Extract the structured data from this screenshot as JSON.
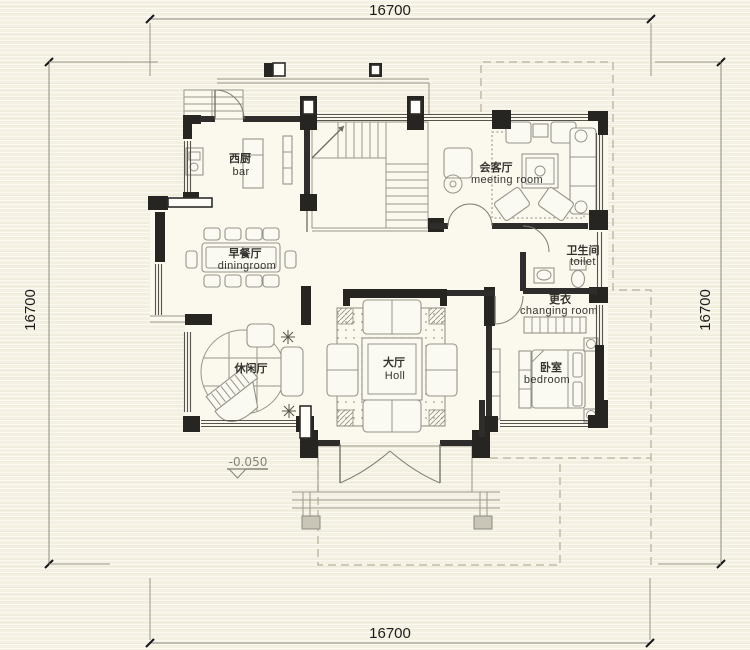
{
  "drawing_title": "floor-plan",
  "dimensions": {
    "top": "16700",
    "bottom": "16700",
    "left": "16700",
    "right": "16700"
  },
  "elevation": "-0.050",
  "rooms": {
    "bar": {
      "zh": "西厨",
      "en": "bar"
    },
    "dining": {
      "zh": "早餐厅",
      "en": "diningroom"
    },
    "leisure": {
      "zh": "休闲厅",
      "en": ""
    },
    "hall": {
      "zh": "大厅",
      "en": "Holl"
    },
    "meeting": {
      "zh": "会客厅",
      "en": "meeting room"
    },
    "toilet": {
      "zh": "卫生间",
      "en": "toilet"
    },
    "changing": {
      "zh": "更衣",
      "en": "changing room"
    },
    "bedroom": {
      "zh": "卧室",
      "en": "bedroom"
    }
  },
  "colors": {
    "paper": "#f4f1e1",
    "wall": "#2e2d2b",
    "thin_line": "#9a978b",
    "dashed_eave": "#b9b19d",
    "text": "#35342f"
  }
}
